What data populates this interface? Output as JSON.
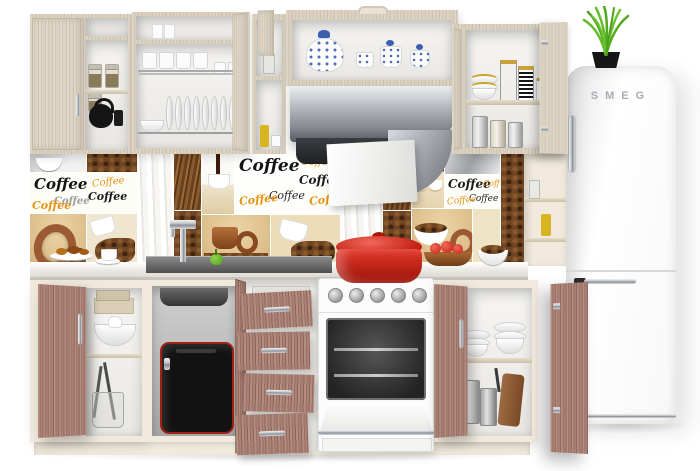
{
  "fridge": {
    "brand": "SMEG"
  },
  "backsplash": {
    "word": "Coffee"
  },
  "palette": {
    "wood_light": "#d8cfbe",
    "wood_rose": "#ab8175",
    "cream": "#f0e9dc",
    "counter_light": "#eceae5",
    "counter_sink_dark": "#5e5e5e",
    "pot_red": "#d03024",
    "toaster_black": "#141414",
    "toaster_red_trim": "#a32014",
    "grass_green": "#58b32c",
    "coffee_text_black": "#141414",
    "coffee_text_orange": "#e8930f",
    "bean_brown": "#6f4522",
    "tile_tan": "#ddbf8c",
    "chrome": "#b9bec4",
    "fridge_white": "#fbfbfb",
    "teaset_blue": "#3a5fae"
  }
}
